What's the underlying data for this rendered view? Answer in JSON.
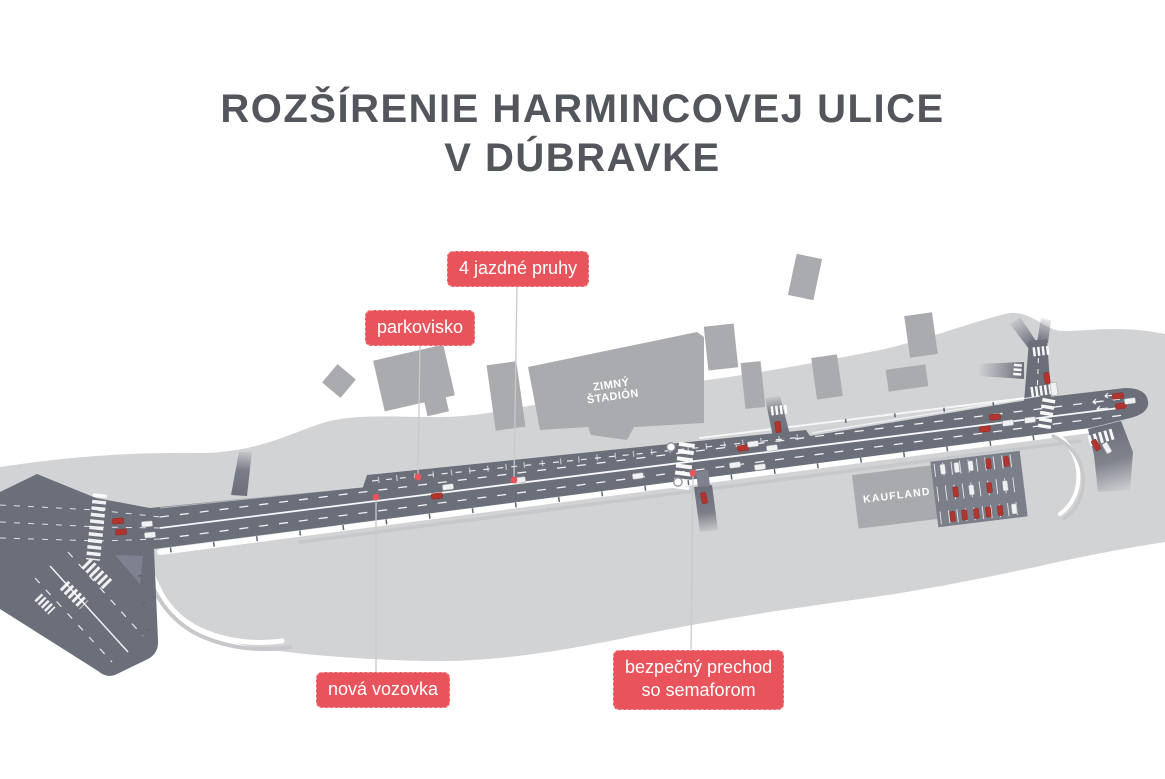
{
  "title": {
    "line1": "ROZŠÍRENIE HARMINCOVEJ ULICE",
    "line2": "V DÚBRAVKE"
  },
  "annotations": {
    "lanes": {
      "label": "4 jazdné pruhy"
    },
    "parking": {
      "label": "parkovisko"
    },
    "new_road": {
      "label": "nová vozovka"
    },
    "crossing": {
      "line1": "bezpečný prechod",
      "line2": "so semaforom"
    }
  },
  "map_labels": {
    "stadium_line1": "ZIMNÝ",
    "stadium_line2": "ŠTADIÓN",
    "kaufland": "KAUFLAND"
  },
  "colors": {
    "accent_red": "#e9545c",
    "road": "#6b6f7a",
    "area": "#d2d3d5",
    "building": "#a9abae",
    "title_text": "#53565c"
  }
}
